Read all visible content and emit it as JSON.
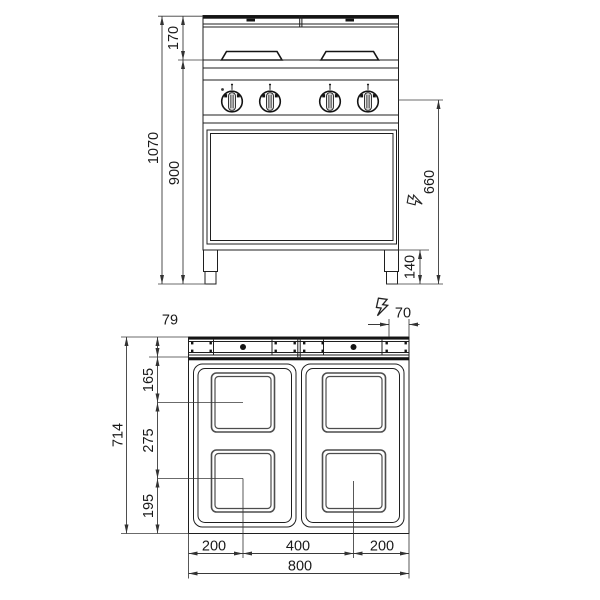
{
  "colors": {
    "ink": "#1f1f1f",
    "dim_line": "#3a3a3a",
    "background": "#ffffff",
    "plate_border": "#4d4d4d"
  },
  "front_view": {
    "dims": {
      "top_section": "170",
      "total_height": "1070",
      "body_height": "900",
      "connection_height": "660",
      "leg_height": "140"
    },
    "icons": {
      "electric_connection": "lightning-bolt-icon"
    }
  },
  "plan_view": {
    "dims": {
      "rail_depth": "79",
      "connection_offset": "70",
      "total_depth": "714",
      "row1_center": "165",
      "row_spacing": "275",
      "row2_bottom": "195",
      "col_left": "200",
      "col_center": "400",
      "col_right": "200",
      "total_width": "800"
    },
    "icons": {
      "electric_connection": "lightning-bolt-icon"
    }
  }
}
